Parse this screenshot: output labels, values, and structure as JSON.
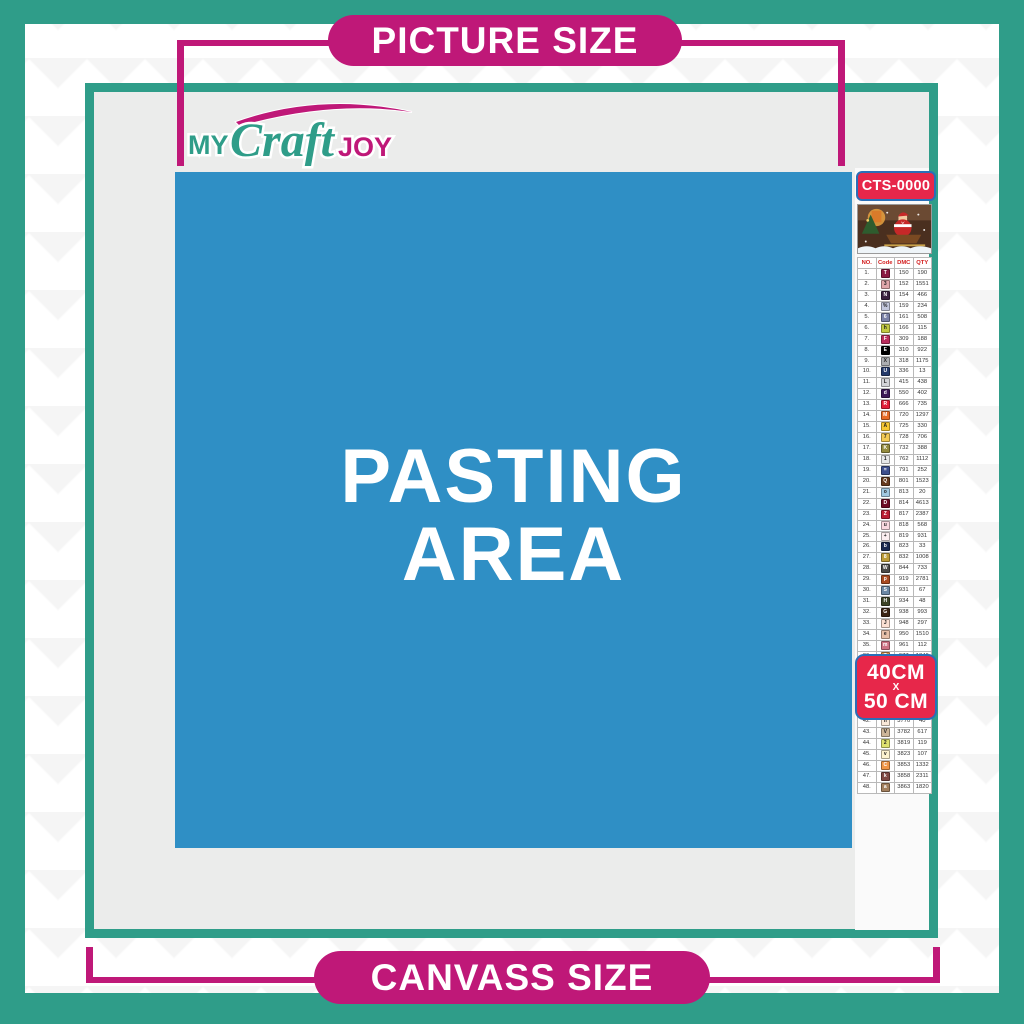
{
  "banners": {
    "top": "PICTURE SIZE",
    "bottom": "CANVASS SIZE"
  },
  "logo": {
    "part1": "MY",
    "part2": "Craft",
    "part3": "JOY"
  },
  "pasting_area": {
    "line1": "PASTING",
    "line2": "AREA"
  },
  "product_code": "CTS-0000",
  "size_label": {
    "line1": "40CM",
    "line2": "X",
    "line3": "50 CM"
  },
  "colors": {
    "teal": "#2f9d89",
    "magenta": "#bf1878",
    "red_label": "#e7274a",
    "label_border_blue": "#2a6fb8",
    "pasting_blue": "#2f8fc5",
    "inner_gray": "#ebeceb"
  },
  "color_chart": {
    "headers": [
      "NO.",
      "Code",
      "DMC",
      "QTY"
    ],
    "rows": [
      {
        "no": "1.",
        "sym": "T",
        "chip": "#8c1843",
        "fg": "#ffffff",
        "dmc": "150",
        "qty": "190"
      },
      {
        "no": "2.",
        "sym": "3",
        "chip": "#e0a6aa",
        "fg": "#222222",
        "dmc": "152",
        "qty": "1551"
      },
      {
        "no": "3.",
        "sym": "N",
        "chip": "#3b2140",
        "fg": "#ffffff",
        "dmc": "154",
        "qty": "466"
      },
      {
        "no": "4.",
        "sym": "%",
        "chip": "#c3c8dd",
        "fg": "#222222",
        "dmc": "159",
        "qty": "234"
      },
      {
        "no": "5.",
        "sym": "6",
        "chip": "#7b82a8",
        "fg": "#ffffff",
        "dmc": "161",
        "qty": "508"
      },
      {
        "no": "6.",
        "sym": "h",
        "chip": "#c2c942",
        "fg": "#222222",
        "dmc": "166",
        "qty": "115"
      },
      {
        "no": "7.",
        "sym": "F",
        "chip": "#ba2d5d",
        "fg": "#ffffff",
        "dmc": "309",
        "qty": "188"
      },
      {
        "no": "8.",
        "sym": "E",
        "chip": "#000000",
        "fg": "#ffffff",
        "dmc": "310",
        "qty": "922"
      },
      {
        "no": "9.",
        "sym": "X",
        "chip": "#acaeb1",
        "fg": "#222222",
        "dmc": "318",
        "qty": "1175"
      },
      {
        "no": "10.",
        "sym": "U",
        "chip": "#243a6b",
        "fg": "#ffffff",
        "dmc": "336",
        "qty": "13"
      },
      {
        "no": "11.",
        "sym": "L",
        "chip": "#d3d4d8",
        "fg": "#222222",
        "dmc": "415",
        "qty": "438"
      },
      {
        "no": "12.",
        "sym": "d",
        "chip": "#3d1a57",
        "fg": "#ffffff",
        "dmc": "550",
        "qty": "402"
      },
      {
        "no": "13.",
        "sym": "R",
        "chip": "#e31d38",
        "fg": "#ffffff",
        "dmc": "666",
        "qty": "735"
      },
      {
        "no": "14.",
        "sym": "M",
        "chip": "#e76b26",
        "fg": "#ffffff",
        "dmc": "720",
        "qty": "1297"
      },
      {
        "no": "15.",
        "sym": "A",
        "chip": "#f7c833",
        "fg": "#222222",
        "dmc": "725",
        "qty": "330"
      },
      {
        "no": "16.",
        "sym": "7",
        "chip": "#f3ca55",
        "fg": "#222222",
        "dmc": "728",
        "qty": "706"
      },
      {
        "no": "17.",
        "sym": "K",
        "chip": "#948b3f",
        "fg": "#ffffff",
        "dmc": "732",
        "qty": "388"
      },
      {
        "no": "18.",
        "sym": "1",
        "chip": "#e6e7e9",
        "fg": "#222222",
        "dmc": "762",
        "qty": "1112"
      },
      {
        "no": "19.",
        "sym": "=",
        "chip": "#3d4f8e",
        "fg": "#ffffff",
        "dmc": "791",
        "qty": "252"
      },
      {
        "no": "20.",
        "sym": "Q",
        "chip": "#653a1f",
        "fg": "#ffffff",
        "dmc": "801",
        "qty": "1523"
      },
      {
        "no": "21.",
        "sym": "o",
        "chip": "#a1c8e1",
        "fg": "#222222",
        "dmc": "813",
        "qty": "20"
      },
      {
        "no": "22.",
        "sym": "D",
        "chip": "#6e0c26",
        "fg": "#ffffff",
        "dmc": "814",
        "qty": "4613"
      },
      {
        "no": "23.",
        "sym": "Z",
        "chip": "#bb1e33",
        "fg": "#ffffff",
        "dmc": "817",
        "qty": "2387"
      },
      {
        "no": "24.",
        "sym": "u",
        "chip": "#f9d9e0",
        "fg": "#222222",
        "dmc": "818",
        "qty": "568"
      },
      {
        "no": "25.",
        "sym": "+",
        "chip": "#fceef0",
        "fg": "#222222",
        "dmc": "819",
        "qty": "931"
      },
      {
        "no": "26.",
        "sym": "b",
        "chip": "#1b2a50",
        "fg": "#ffffff",
        "dmc": "823",
        "qty": "33"
      },
      {
        "no": "27.",
        "sym": "8",
        "chip": "#bd9c38",
        "fg": "#ffffff",
        "dmc": "832",
        "qty": "1008"
      },
      {
        "no": "28.",
        "sym": "W",
        "chip": "#4b4a48",
        "fg": "#ffffff",
        "dmc": "844",
        "qty": "733"
      },
      {
        "no": "29.",
        "sym": "p",
        "chip": "#a84a21",
        "fg": "#ffffff",
        "dmc": "919",
        "qty": "2781"
      },
      {
        "no": "30.",
        "sym": "S",
        "chip": "#6b88a5",
        "fg": "#ffffff",
        "dmc": "931",
        "qty": "67"
      },
      {
        "no": "31.",
        "sym": "H",
        "chip": "#3c4326",
        "fg": "#ffffff",
        "dmc": "934",
        "qty": "48"
      },
      {
        "no": "32.",
        "sym": "G",
        "chip": "#3b2413",
        "fg": "#ffffff",
        "dmc": "938",
        "qty": "993"
      },
      {
        "no": "33.",
        "sym": "J",
        "chip": "#fce0d2",
        "fg": "#222222",
        "dmc": "948",
        "qty": "297"
      },
      {
        "no": "34.",
        "sym": "e",
        "chip": "#e7c0a8",
        "fg": "#222222",
        "dmc": "950",
        "qty": "1510"
      },
      {
        "no": "35.",
        "sym": "m",
        "chip": "#cd7284",
        "fg": "#ffffff",
        "dmc": "961",
        "qty": "112"
      },
      {
        "no": "36.",
        "sym": "T",
        "chip": "#d4914e",
        "fg": "#ffffff",
        "dmc": "977",
        "qty": "1346"
      },
      {
        "no": "37.",
        "sym": "P",
        "chip": "#967b90",
        "fg": "#ffffff",
        "dmc": "3041",
        "qty": "1312"
      },
      {
        "no": "38.",
        "sym": "r",
        "chip": "#c05e63",
        "fg": "#ffffff",
        "dmc": "3328",
        "qty": "660"
      },
      {
        "no": "39.",
        "sym": "O",
        "chip": "#73825e",
        "fg": "#ffffff",
        "dmc": "3363",
        "qty": "144"
      },
      {
        "no": "40.",
        "sym": "B",
        "chip": "#241409",
        "fg": "#ffffff",
        "dmc": "3371",
        "qty": "1680"
      },
      {
        "no": "41.",
        "sym": "Y",
        "chip": "#dcd6e3",
        "fg": "#222222",
        "dmc": "3743",
        "qty": "1738"
      },
      {
        "no": "42.",
        "sym": "n",
        "chip": "#f9e8d8",
        "fg": "#222222",
        "dmc": "3770",
        "qty": "40"
      },
      {
        "no": "43.",
        "sym": "V",
        "chip": "#cdb699",
        "fg": "#222222",
        "dmc": "3782",
        "qty": "617"
      },
      {
        "no": "44.",
        "sym": "2",
        "chip": "#dfe26f",
        "fg": "#222222",
        "dmc": "3819",
        "qty": "119"
      },
      {
        "no": "45.",
        "sym": "v",
        "chip": "#fdf3cf",
        "fg": "#222222",
        "dmc": "3823",
        "qty": "107"
      },
      {
        "no": "46.",
        "sym": "C",
        "chip": "#ef9546",
        "fg": "#ffffff",
        "dmc": "3853",
        "qty": "1332"
      },
      {
        "no": "47.",
        "sym": "k",
        "chip": "#7f4944",
        "fg": "#ffffff",
        "dmc": "3858",
        "qty": "2311"
      },
      {
        "no": "48.",
        "sym": "a",
        "chip": "#a3805f",
        "fg": "#ffffff",
        "dmc": "3863",
        "qty": "1820"
      }
    ]
  }
}
